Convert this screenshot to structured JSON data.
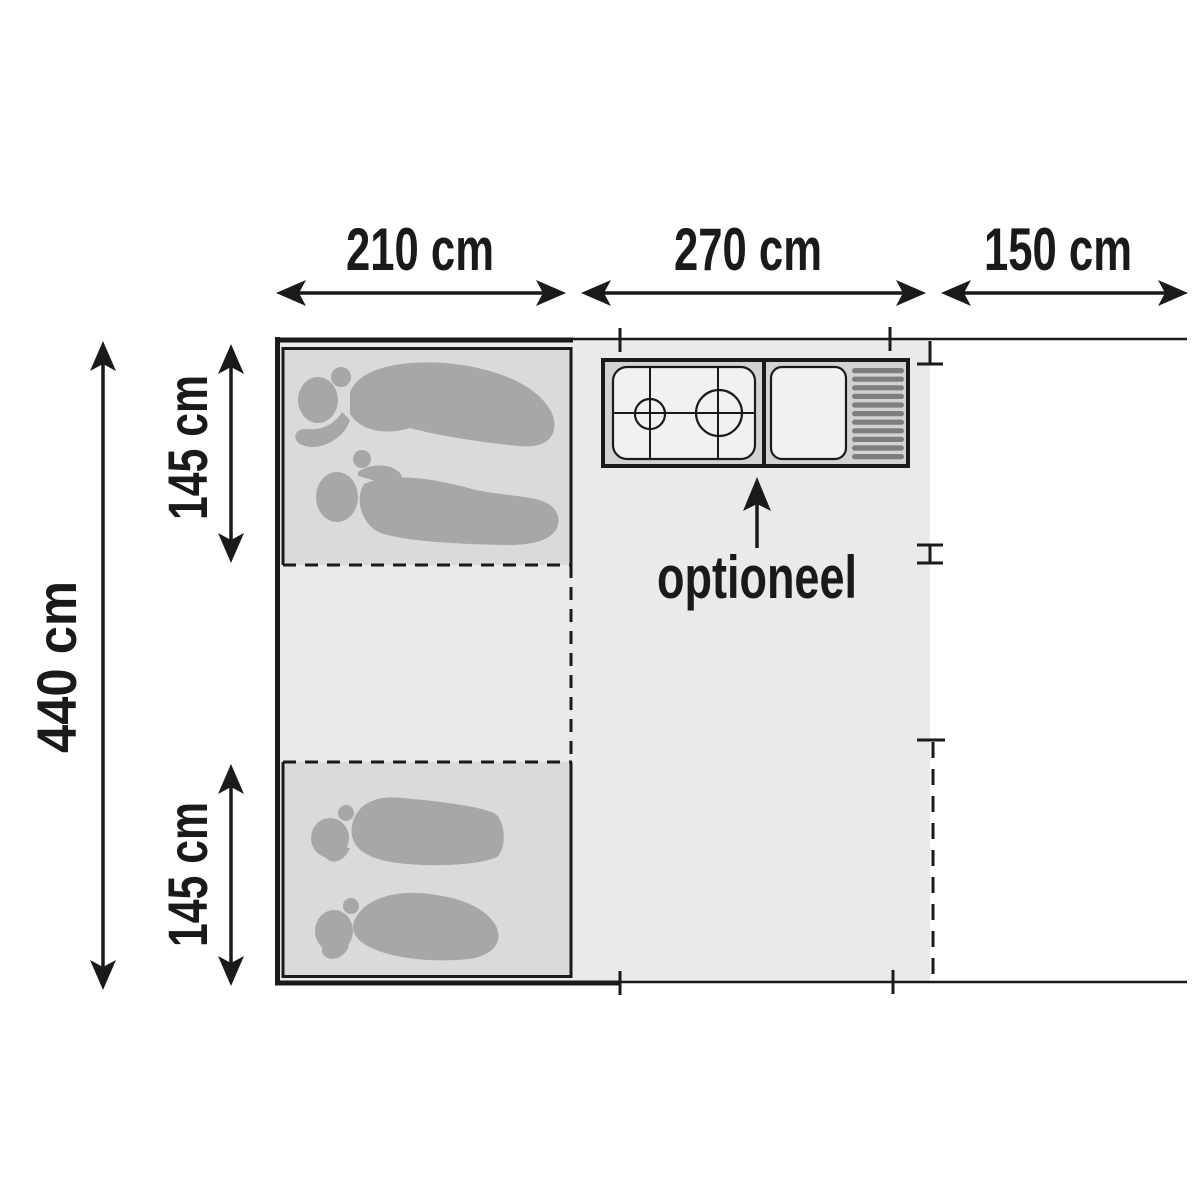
{
  "floor_plan": {
    "type": "tent-floor-plan",
    "dimensions": {
      "top": [
        {
          "id": "sleeping-section-width",
          "label": "210 cm"
        },
        {
          "id": "living-section-width",
          "label": "270 cm"
        },
        {
          "id": "canopy-section-width",
          "label": "150 cm"
        }
      ],
      "left": [
        {
          "id": "total-depth",
          "label": "440 cm"
        },
        {
          "id": "top-cabin-depth",
          "label": "145 cm"
        },
        {
          "id": "bottom-cabin-depth",
          "label": "145 cm"
        }
      ]
    },
    "annotations": {
      "kitchen_optional": "optioneel"
    },
    "icons": {
      "kitchen_left": "stove-two-burners",
      "kitchen_right": "sink-with-drain-rack",
      "annotation_pointer": "arrow-up"
    },
    "colors": {
      "background": "#ffffff",
      "line": "#1a1a1a",
      "floor": "#eaeaea",
      "cabin_floor": "#dadada",
      "sleeping_figure": "#a7a7a7",
      "kitchen_body": "#d2d2d2",
      "kitchen_surface": "#f1f1f1",
      "drain_stripe": "#7e7e7e"
    }
  }
}
